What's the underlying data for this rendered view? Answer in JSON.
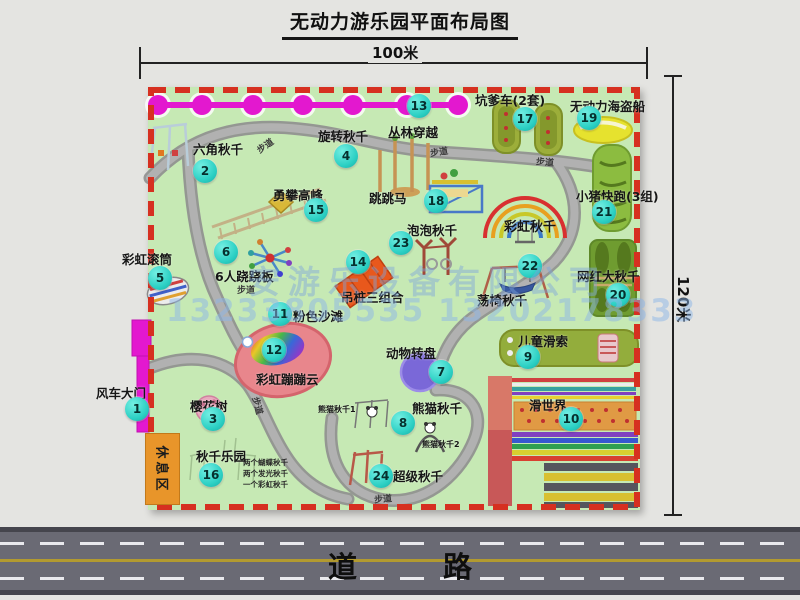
{
  "title": "无动力游乐园平面布局图",
  "dimensions": {
    "top": "100米",
    "right": "120米"
  },
  "road": {
    "label": "道 路"
  },
  "watermark": {
    "company": "安游乐设备有限公司",
    "phone": "13233805535 13202178333"
  },
  "colors": {
    "map_bg": "#c6e9b4",
    "border_dashed": "#d63020",
    "marker": "#2cd0c4",
    "jungle_line": "#e318cf",
    "road": "#6a6a74",
    "rest_area": "#e8952a"
  },
  "map": {
    "rest_area": {
      "label": "休息区"
    },
    "pois": [
      {
        "num": "1",
        "label": "风车大门",
        "cx": 137,
        "cy": 409,
        "lx": 96,
        "ly": 383
      },
      {
        "num": "2",
        "label": "六角秋千",
        "cx": 205,
        "cy": 171,
        "lx": 193,
        "ly": 139
      },
      {
        "num": "3",
        "label": "樱花树",
        "cx": 213,
        "cy": 419,
        "lx": 190,
        "ly": 396
      },
      {
        "num": "4",
        "label": "旋转秋千",
        "cx": 346,
        "cy": 156,
        "lx": 318,
        "ly": 126
      },
      {
        "num": "5",
        "label": "彩虹滚筒",
        "cx": 160,
        "cy": 278,
        "lx": 122,
        "ly": 249
      },
      {
        "num": "6",
        "label": "6人跷跷板",
        "cx": 226,
        "cy": 252,
        "lx": 215,
        "ly": 266
      },
      {
        "num": "7",
        "label": "动物转盘",
        "cx": 441,
        "cy": 372,
        "lx": 386,
        "ly": 343
      },
      {
        "num": "8",
        "label": "熊猫秋千",
        "cx": 403,
        "cy": 423,
        "lx": 412,
        "ly": 398
      },
      {
        "num": "9",
        "label": "儿童滑索",
        "cx": 528,
        "cy": 357,
        "lx": 518,
        "ly": 331
      },
      {
        "num": "10",
        "label": "滑世界",
        "cx": 571,
        "cy": 419,
        "lx": 529,
        "ly": 395
      },
      {
        "num": "11",
        "label": "粉色沙滩",
        "cx": 280,
        "cy": 314,
        "lx": 293,
        "ly": 306
      },
      {
        "num": "12",
        "label": "彩虹蹦蹦云",
        "cx": 274,
        "cy": 350,
        "lx": 256,
        "ly": 369
      },
      {
        "num": "13",
        "label": "丛林穿越",
        "cx": 419,
        "cy": 106,
        "lx": 388,
        "ly": 122
      },
      {
        "num": "14",
        "label": "吊桩三组合",
        "cx": 358,
        "cy": 262,
        "lx": 341,
        "ly": 287
      },
      {
        "num": "15",
        "label": "勇攀高峰",
        "cx": 316,
        "cy": 210,
        "lx": 273,
        "ly": 185
      },
      {
        "num": "16",
        "label": "秋千乐园",
        "cx": 211,
        "cy": 475,
        "lx": 196,
        "ly": 446
      },
      {
        "num": "17",
        "label": "坑爹车(2套)",
        "cx": 525,
        "cy": 119,
        "lx": 475,
        "ly": 90
      },
      {
        "num": "18",
        "label": "跳跳马",
        "cx": 436,
        "cy": 201,
        "lx": 369,
        "ly": 188
      },
      {
        "num": "19",
        "label": "无动力海盗船",
        "cx": 589,
        "cy": 118,
        "lx": 570,
        "ly": 96
      },
      {
        "num": "20",
        "label": "网红大秋千",
        "cx": 618,
        "cy": 295,
        "lx": 577,
        "ly": 266
      },
      {
        "num": "21",
        "label": "小猪快跑(3组)",
        "cx": 604,
        "cy": 212,
        "lx": 576,
        "ly": 186
      },
      {
        "num": "22",
        "label": "荡椅秋千",
        "cx": 530,
        "cy": 266,
        "lx": 477,
        "ly": 290
      },
      {
        "num": "23",
        "label": "泡泡秋千",
        "cx": 401,
        "cy": 243,
        "lx": 407,
        "ly": 220
      },
      {
        "num": "24",
        "label": "超级秋千",
        "cx": 381,
        "cy": 476,
        "lx": 393,
        "ly": 466
      }
    ],
    "path_labels": [
      {
        "text": "步道",
        "x": 256,
        "y": 139,
        "rot": -35
      },
      {
        "text": "步道",
        "x": 430,
        "y": 145,
        "rot": -8
      },
      {
        "text": "步道",
        "x": 536,
        "y": 155,
        "rot": 5
      },
      {
        "text": "步道",
        "x": 237,
        "y": 283,
        "rot": 0
      },
      {
        "text": "步道",
        "x": 249,
        "y": 399,
        "rot": 75
      },
      {
        "text": "步道",
        "x": 374,
        "y": 492,
        "rot": -5
      }
    ],
    "extra_labels": [
      {
        "text": "彩虹秋千",
        "x": 504,
        "y": 216,
        "size": 13
      },
      {
        "text": "熊猫秋千1",
        "x": 318,
        "y": 404,
        "size": 8
      },
      {
        "text": "熊猫秋千2",
        "x": 422,
        "y": 439,
        "size": 8
      }
    ],
    "swing_park_details": [
      "两个蝴蝶秋千",
      "两个发光秋千",
      "一个彩虹秋千"
    ]
  }
}
